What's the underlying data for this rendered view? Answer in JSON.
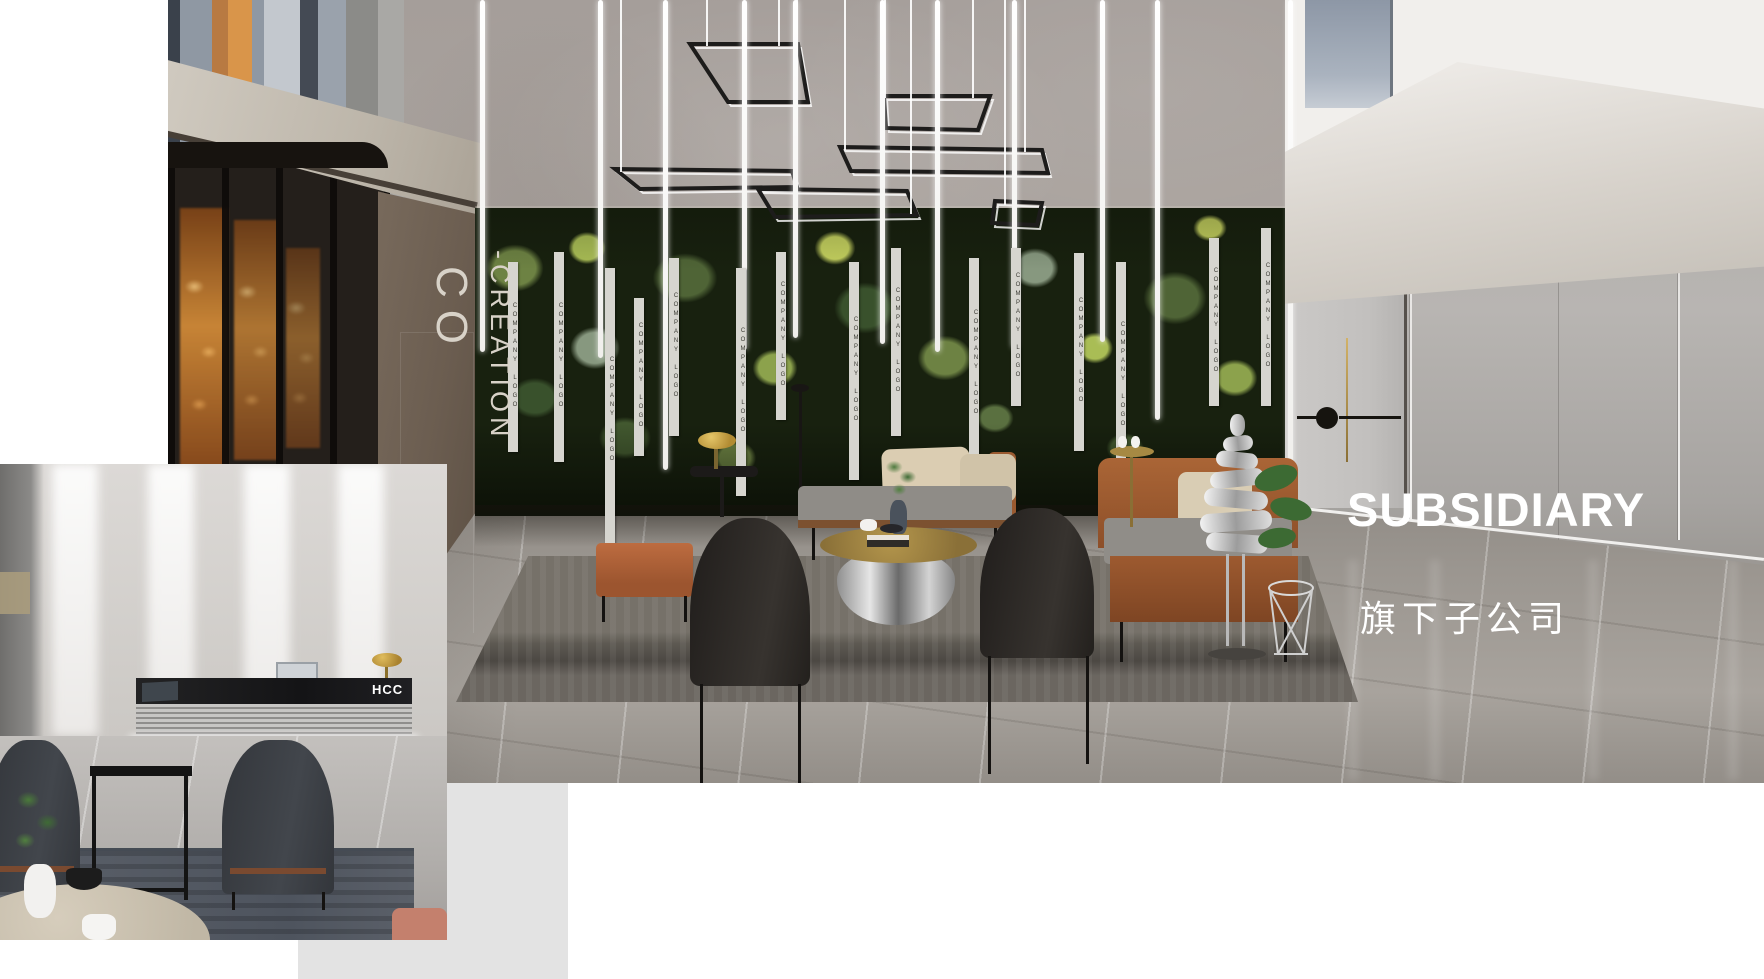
{
  "scene": {
    "title": "SUBSIDIARY",
    "subtitle": "旗下子公司",
    "entrance_sign": {
      "line1": "CO",
      "line2": "-CREATION"
    },
    "plant_wall_strip_text": "COMPANY LOGO",
    "inset_desk_logo": "HCC"
  },
  "colors": {
    "title_text": "#ffffff",
    "subtitle_text": "#ffffff",
    "sign_text": "#d8d2c8",
    "brown_wall": "#6b5d50",
    "plant_wall_dark": "#18210f",
    "terracotta_bench": "#b2653d",
    "cognac_sofa": "#9d5a30",
    "gray_panel": "#e3e3e3",
    "logo_strip_bg": "#d6d5cf",
    "logo_strip_ink": "#3a3a33",
    "desk_logo_bg": "#1a1a1c"
  },
  "decor": {
    "tubes": [
      {
        "x": 312,
        "h": 352
      },
      {
        "x": 430,
        "h": 358
      },
      {
        "x": 495,
        "h": 470
      },
      {
        "x": 574,
        "h": 350
      },
      {
        "x": 625,
        "h": 338
      },
      {
        "x": 712,
        "h": 344
      },
      {
        "x": 767,
        "h": 352
      },
      {
        "x": 844,
        "h": 348
      },
      {
        "x": 932,
        "h": 342
      },
      {
        "x": 987,
        "h": 420
      },
      {
        "x": 1120,
        "h": 478
      }
    ],
    "cables": [
      {
        "x": 538,
        "h": 46
      },
      {
        "x": 610,
        "h": 46
      },
      {
        "x": 716,
        "h": 98
      },
      {
        "x": 804,
        "h": 98
      },
      {
        "x": 676,
        "h": 150
      },
      {
        "x": 856,
        "h": 152
      },
      {
        "x": 452,
        "h": 172
      },
      {
        "x": 628,
        "h": 190
      },
      {
        "x": 742,
        "h": 214
      },
      {
        "x": 836,
        "h": 205
      }
    ],
    "strips": [
      {
        "x": 340,
        "y": 262,
        "h": 190
      },
      {
        "x": 386,
        "y": 252,
        "h": 210
      },
      {
        "x": 437,
        "y": 268,
        "h": 285
      },
      {
        "x": 466,
        "y": 298,
        "h": 158
      },
      {
        "x": 501,
        "y": 258,
        "h": 178
      },
      {
        "x": 568,
        "y": 268,
        "h": 228
      },
      {
        "x": 608,
        "y": 252,
        "h": 168
      },
      {
        "x": 681,
        "y": 262,
        "h": 218
      },
      {
        "x": 723,
        "y": 248,
        "h": 188
      },
      {
        "x": 801,
        "y": 258,
        "h": 212
      },
      {
        "x": 843,
        "y": 248,
        "h": 158
      },
      {
        "x": 906,
        "y": 253,
        "h": 198
      },
      {
        "x": 948,
        "y": 262,
        "h": 228
      },
      {
        "x": 1041,
        "y": 238,
        "h": 168
      },
      {
        "x": 1093,
        "y": 228,
        "h": 178
      }
    ],
    "pendant_lights": [
      "522,44 630,44 640,102 560,102",
      "716,96 822,96 810,130 718,128",
      "672,147 874,150 880,173 683,171",
      "447,169 624,171 629,187 472,189",
      "590,189 739,191 749,215 607,217",
      "827,201 874,203 869,225 824,223"
    ],
    "ceiling_lights": [
      {
        "x": 1232,
        "y": 226
      },
      {
        "x": 1352,
        "y": 196
      },
      {
        "x": 1538,
        "y": 148
      }
    ]
  }
}
